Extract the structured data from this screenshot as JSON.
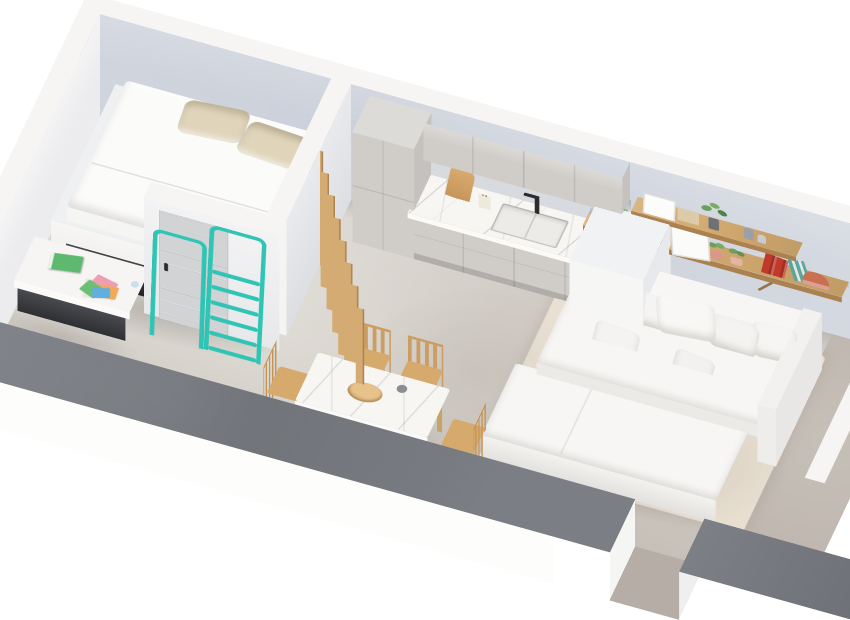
{
  "meta": {
    "title": "3D isometric cutaway rendering of a studio apartment",
    "view": "dollhouse axonometric, walls cut horizontally",
    "background": "#ffffff"
  },
  "colors": {
    "wall_inner": "#cbd0da",
    "wall_inner_light": "#ececee",
    "wall_cut_white": "#f6f5f3",
    "wall_cut_dark": "#74787e",
    "wall_outer": "#fdfdfc",
    "floor": "#d8d3cc",
    "floor_dark": "#c0b8b0",
    "rug": "#e8dfd1",
    "teal": "#2fc4b3",
    "wood": "#d2a96f",
    "wood_slat": "#d4ab72",
    "wood_dark": "#ab8150",
    "cabinet": "#d0cdc9",
    "cabinet_side": "#c4c1be",
    "marble": "#f7f6f3",
    "door_gray": "#d1d3d5",
    "bed_white": "#fbfbfa",
    "pillow_beige": "#e0d5bb",
    "sofa_white": "#f7f6f4",
    "book_green": "#5cb96f",
    "book_red": "#c0392b",
    "plant_green": "#6a9f5d",
    "dark_wood": "#7b5536",
    "metal_dark": "#2c2c2f",
    "nook_dark": "#35363b"
  },
  "objects": {
    "bedroom": [
      "loft-bed-platform",
      "white-mattress",
      "beige-pillow x2",
      "teal-ladder",
      "teal-safety-hoop",
      "under-loft-nook",
      "desk",
      "green-book",
      "colorful-papers",
      "interior-door"
    ],
    "divider": [
      "wooden-slat-screen x9"
    ],
    "kitchen": [
      "tall-cabinet",
      "upper-cabinets",
      "base-cabinets",
      "marble-countertop",
      "sink",
      "black-faucet",
      "cutting-board",
      "utensil-jar",
      "white-partition-block"
    ],
    "dining": [
      "marble-table",
      "wooden-chair x4",
      "wooden-bowl",
      "small-cup"
    ],
    "living": [
      "sofa-bed",
      "white-pillow x7",
      "beige-rug",
      "wood-shelf x2",
      "plant-vase x3",
      "book-row",
      "white-frame x2",
      "terracotta-pots",
      "red-books",
      "decor-arc"
    ],
    "entry": [
      "front-wall-opening",
      "dark-wood-door-partial"
    ]
  }
}
